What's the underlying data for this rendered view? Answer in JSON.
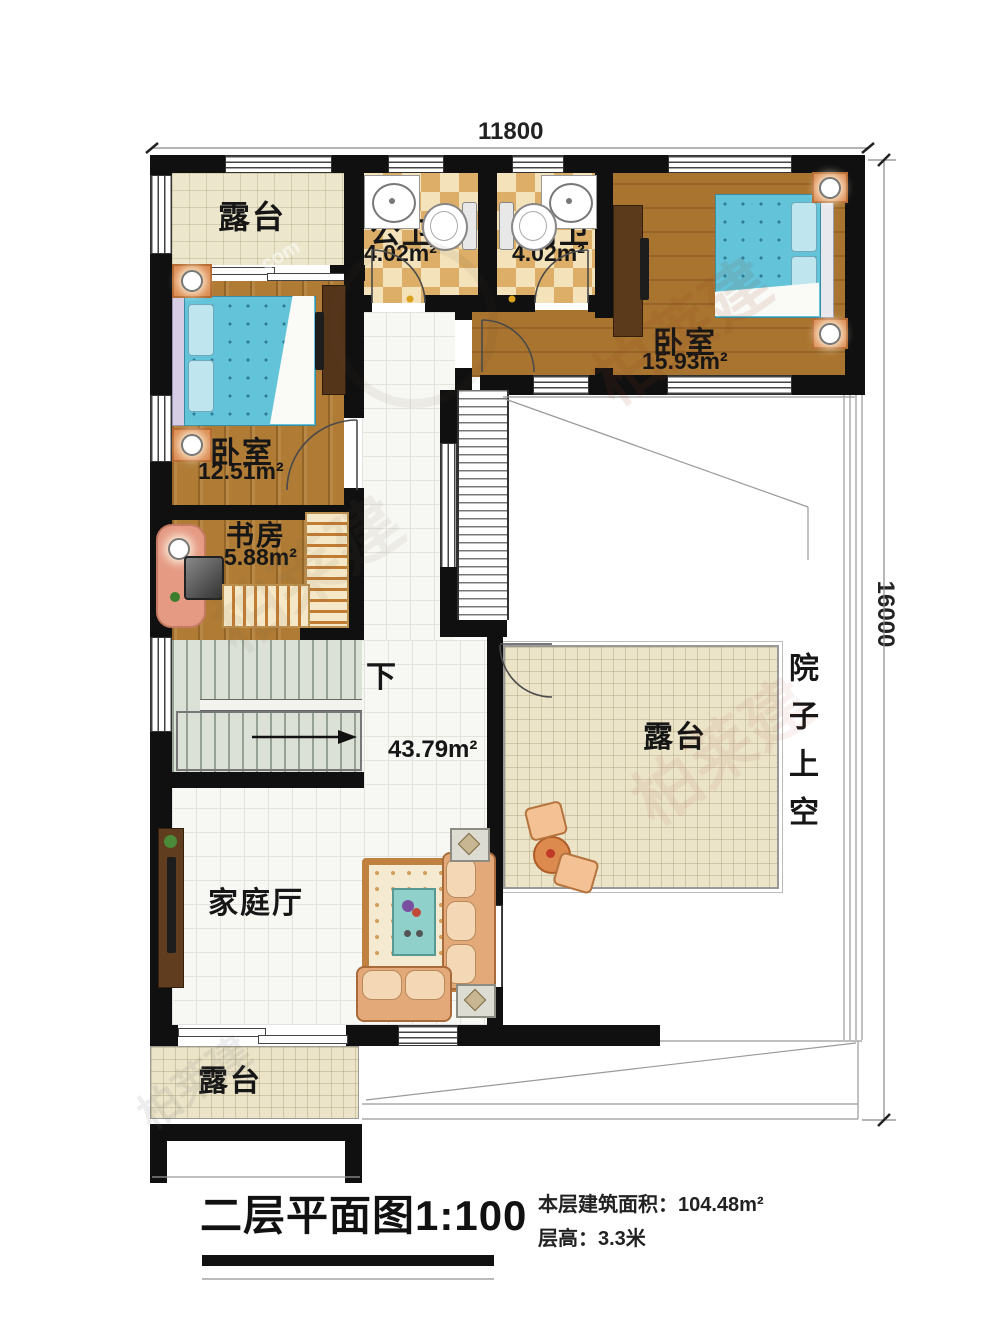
{
  "dimensions": {
    "top": "11800",
    "right": "16000"
  },
  "rooms": {
    "terrace_top": {
      "name": "露台"
    },
    "public_bath": {
      "name": "公卫",
      "area": "4.02m²"
    },
    "inner_bath": {
      "name": "内卫",
      "area": "4.02m²"
    },
    "bedroom_right": {
      "name": "卧室",
      "area": "15.93m²"
    },
    "bedroom_left": {
      "name": "卧室",
      "area": "12.51m²"
    },
    "study": {
      "name": "书房",
      "area": "5.88m²"
    },
    "hall": {
      "area": "43.79m²",
      "stair_label": "下"
    },
    "family_room": {
      "name": "家庭厅"
    },
    "terrace_mid": {
      "name": "露台"
    },
    "terrace_bottom": {
      "name": "露台"
    },
    "courtyard": {
      "name": "院子上空"
    }
  },
  "title_block": {
    "title": "二层平面图1:100",
    "info_line1": "本层建筑面积：104.48m²",
    "info_line2": "层高：3.3米"
  },
  "watermark": {
    "text": "柏莱建",
    "suffix": ".com"
  },
  "colors": {
    "wall": "#101010",
    "wood_floor": "#b07b35",
    "beige_tile": "#ebe4c9",
    "checker_dark": "#dcae67",
    "checker_light": "#f4e2ba",
    "bed_blue": "#62c3d9",
    "sofa_peach": "#e9b98d",
    "stair_floor": "#dce1d7"
  }
}
